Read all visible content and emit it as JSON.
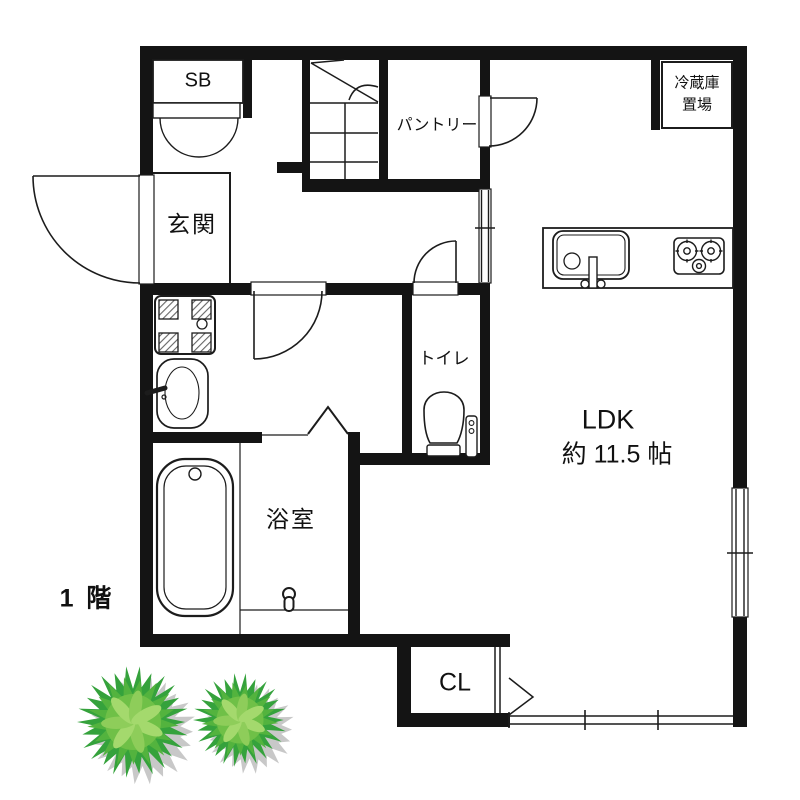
{
  "title": "1階 間取り図",
  "floor_label": "1 階",
  "rooms": {
    "shoe_box": {
      "label": "SB"
    },
    "entrance": {
      "label": "玄関"
    },
    "pantry": {
      "label": "パントリー"
    },
    "refrigerator_space": {
      "label_line1": "冷蔵庫",
      "label_line2": "置場"
    },
    "toilet": {
      "label": "トイレ"
    },
    "ldk": {
      "label": "LDK",
      "area": "約 11.5 帖"
    },
    "bathroom": {
      "label": "浴室"
    },
    "closet": {
      "label": "CL"
    }
  },
  "icons": [
    "stairs-icon",
    "door-swing-icon",
    "double-door-icon",
    "folding-door-icon",
    "sliding-window-icon",
    "opening-icon",
    "kitchen-sink-icon",
    "faucet-icon",
    "stove-icon",
    "refrigerator-space-box",
    "washing-machine-pan-icon",
    "washbasin-icon",
    "bathtub-icon",
    "shower-icon",
    "toilet-icon",
    "tree-icon"
  ],
  "colors": {
    "wall": "#141414",
    "line": "#1c1c1c",
    "paper": "#ffffff",
    "tree_dark": "#35a23c",
    "tree_mid": "#53b33e",
    "tree_core": "#6fc047",
    "tree_leaf": "#8ecd5a",
    "tree_leaf2": "#a4d96d",
    "tree_shadow": "#c8c8c8"
  },
  "trees": [
    {
      "cx": 133,
      "cy": 722,
      "r": 56
    },
    {
      "cx": 240,
      "cy": 720,
      "r": 47
    }
  ]
}
